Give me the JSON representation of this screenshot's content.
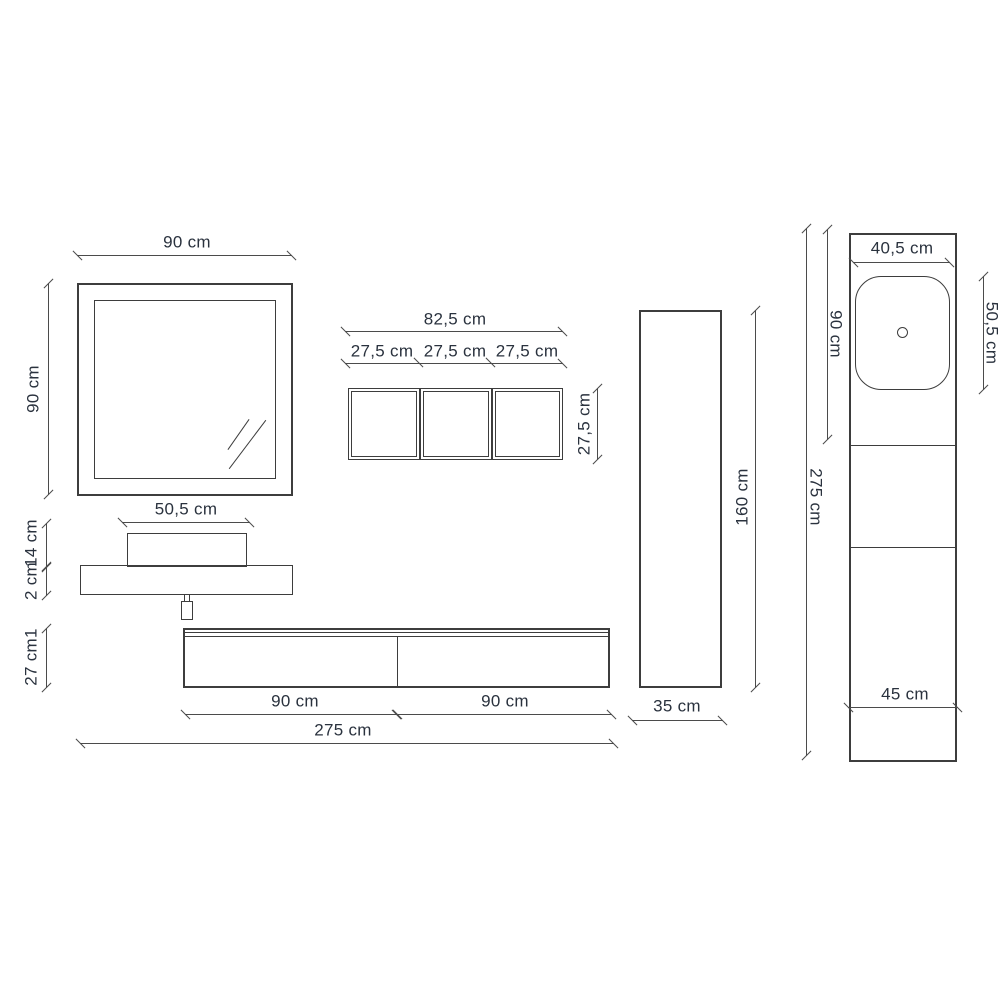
{
  "diagram": {
    "mirror": {
      "width_label": "90 cm",
      "height_label": "90 cm"
    },
    "wall_boxes": {
      "total_width_label": "82,5 cm",
      "box_width_labels": [
        "27,5 cm",
        "27,5 cm",
        "27,5 cm"
      ],
      "height_label": "27,5 cm"
    },
    "washbasin_shelf": {
      "width_label": "50,5 cm",
      "basin_height_label": "14 cm",
      "shelf_thickness_label": "2 cm"
    },
    "base_cabinet": {
      "height_label": "27 cm1",
      "left_section_label": "90 cm",
      "right_section_label": "90 cm",
      "total_width_label": "275 cm"
    },
    "tall_cabinet": {
      "height_label": "160 cm",
      "width_label": "35 cm"
    },
    "side_column": {
      "top_width_label": "40,5 cm",
      "upper_section_height_label": "90 cm",
      "basin_length_label": "50,5 cm",
      "total_height_label": "275 cm",
      "base_width_label": "45 cm"
    },
    "colors": {
      "line": "#3d3d3d",
      "dim_line": "#4b4b4b",
      "text": "#2a323e",
      "background": "#ffffff"
    }
  }
}
